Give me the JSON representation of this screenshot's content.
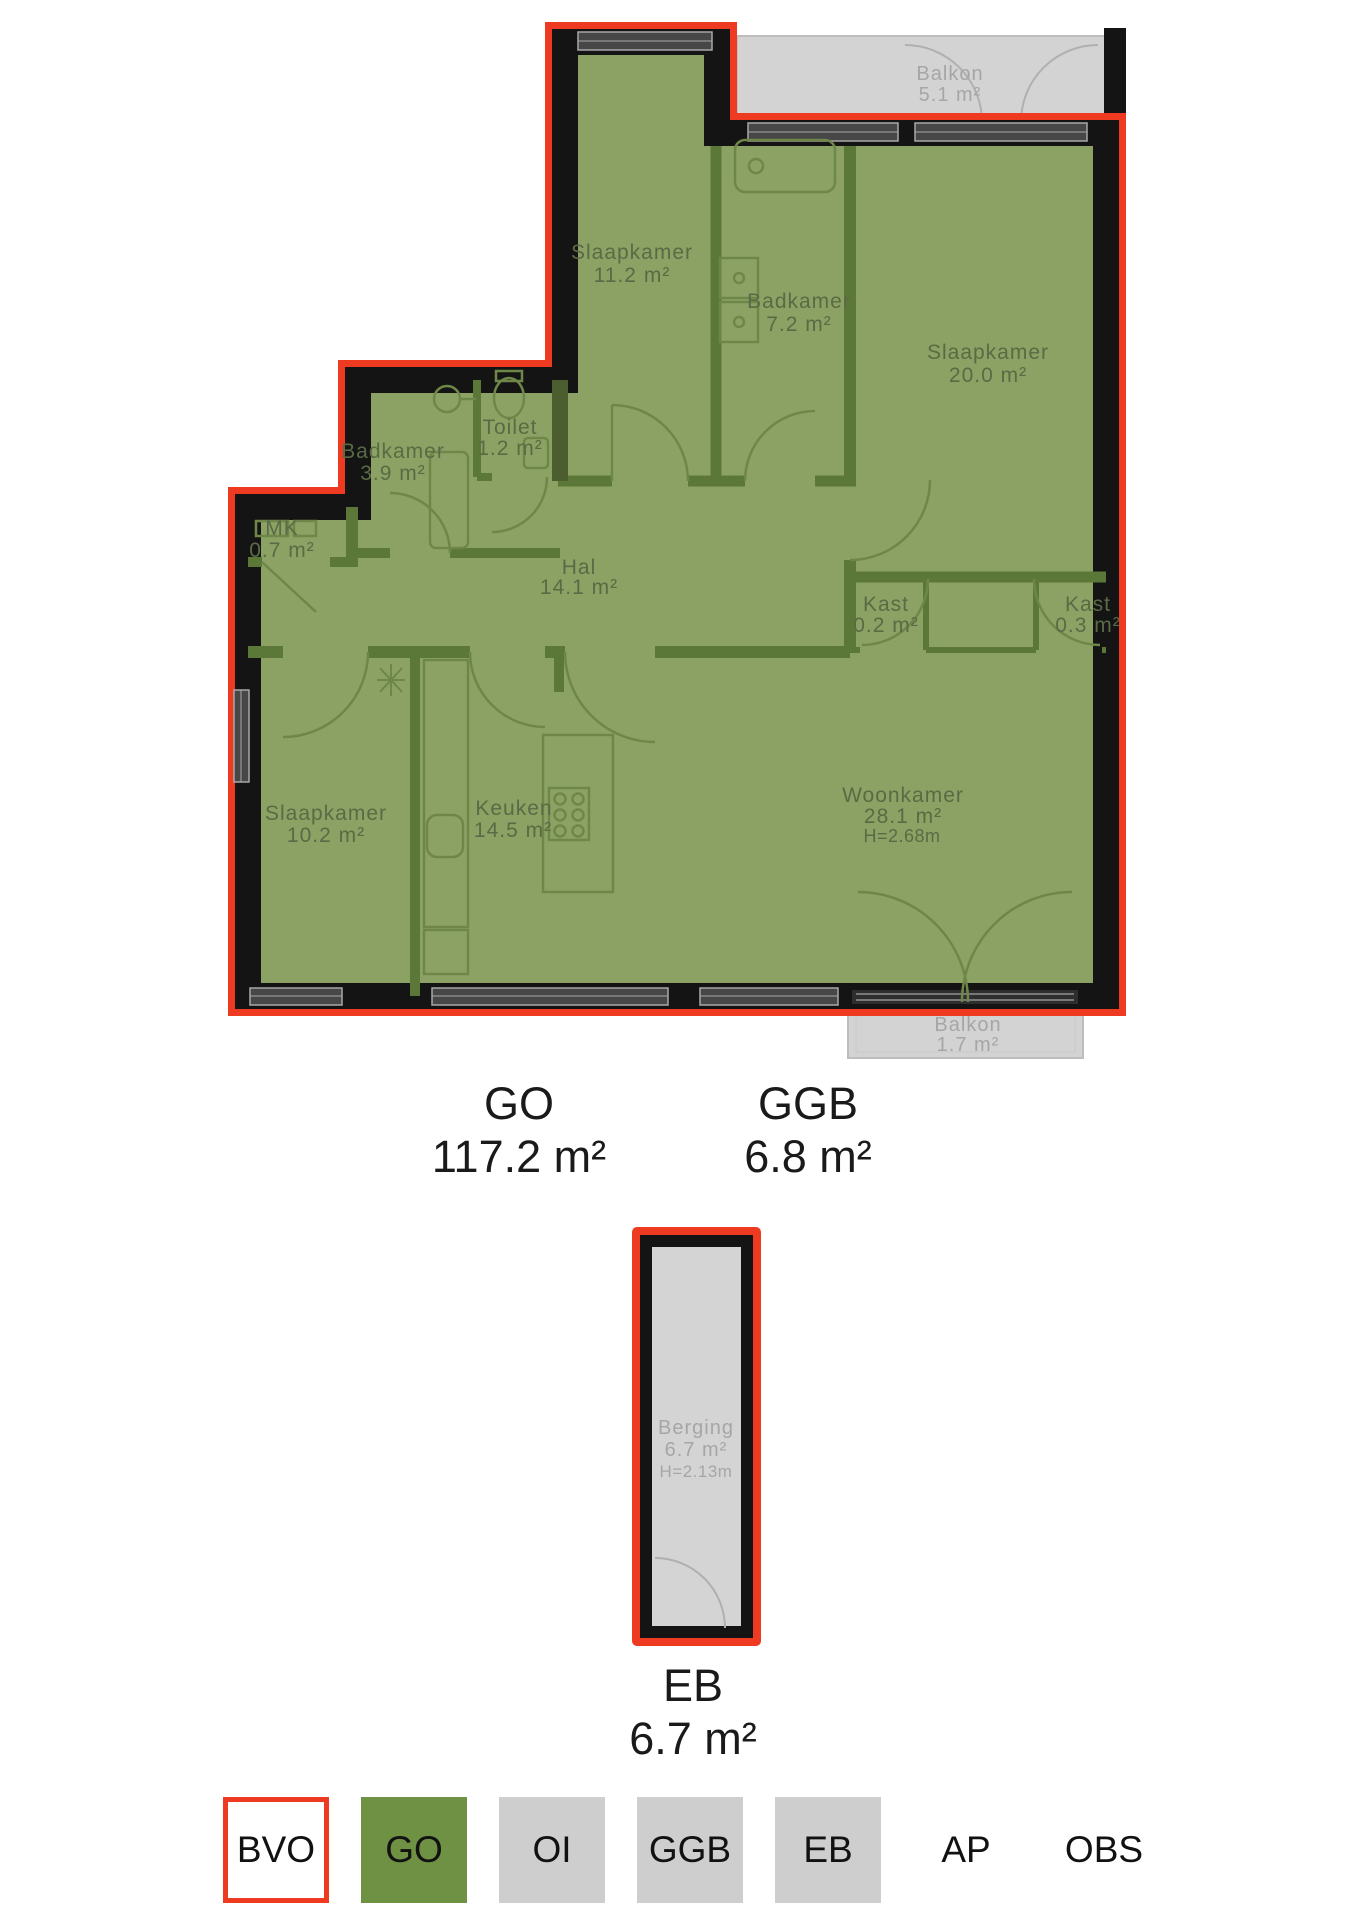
{
  "colors": {
    "bvo_outline_red": "#ee3a21",
    "wall_black": "#141414",
    "go_green_fill": "#8ca264",
    "interior_wall_green": "#5c7839",
    "legend_green": "#6f9144",
    "outdoor_gray": "#d3d3d3",
    "legend_gray": "#cecece",
    "gray_text": "#a6a6a6",
    "room_text": "#5a6a45"
  },
  "floorplan": {
    "rooms": [
      {
        "name": "Slaapkamer",
        "area": "11.2 m²"
      },
      {
        "name": "Badkamer",
        "area": "7.2 m²"
      },
      {
        "name": "Slaapkamer",
        "area": "20.0 m²"
      },
      {
        "name": "Badkamer",
        "area": "3.9 m²"
      },
      {
        "name": "Toilet",
        "area": "1.2 m²"
      },
      {
        "name": "MK",
        "area": "0.7 m²"
      },
      {
        "name": "Hal",
        "area": "14.1 m²"
      },
      {
        "name": "Kast",
        "area": "0.2 m²"
      },
      {
        "name": "Kast",
        "area": "0.3 m²"
      },
      {
        "name": "Slaapkamer",
        "area": "10.2 m²"
      },
      {
        "name": "Keuken",
        "area": "14.5 m²"
      },
      {
        "name": "Woonkamer",
        "area": "28.1 m²",
        "height": "H=2.68m"
      }
    ],
    "balconies": [
      {
        "name": "Balkon",
        "area": "5.1 m²"
      },
      {
        "name": "Balkon",
        "area": "1.7 m²"
      }
    ],
    "storage": {
      "name": "Berging",
      "area": "6.7 m²",
      "height": "H=2.13m"
    }
  },
  "area_summary": {
    "go": {
      "code": "GO",
      "value": "117.2 m²"
    },
    "ggb": {
      "code": "GGB",
      "value": "6.8 m²"
    },
    "eb": {
      "code": "EB",
      "value": "6.7 m²"
    }
  },
  "legend": {
    "items": [
      {
        "label": "BVO",
        "swatch": "red-outline"
      },
      {
        "label": "GO",
        "swatch": "green"
      },
      {
        "label": "OI",
        "swatch": "gray"
      },
      {
        "label": "GGB",
        "swatch": "gray"
      },
      {
        "label": "EB",
        "swatch": "gray"
      },
      {
        "label": "AP",
        "swatch": "none"
      },
      {
        "label": "OBS",
        "swatch": "none"
      }
    ]
  }
}
